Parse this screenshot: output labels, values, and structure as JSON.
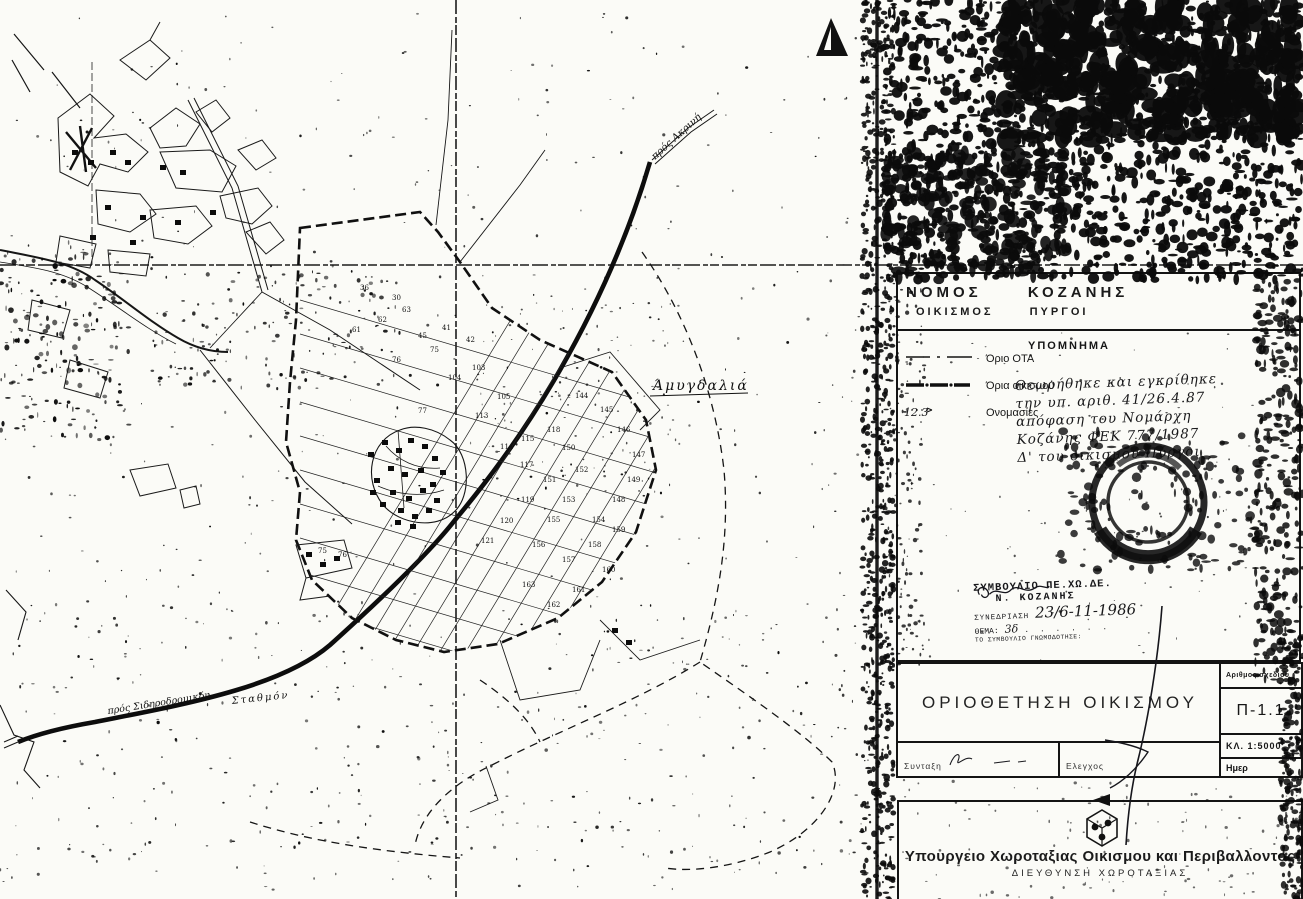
{
  "map": {
    "labels": {
      "area_name": "Άμυγδαλιά",
      "road_to_top": "πρός Ακρινή",
      "road_bottom_left": "πρός Σιδηροδρομικόν",
      "station": "Σταθμόν"
    },
    "parcel_numbers": [
      {
        "x": 418,
        "y": 413,
        "n": "77"
      },
      {
        "x": 448,
        "y": 380,
        "n": "104"
      },
      {
        "x": 472,
        "y": 370,
        "n": "103"
      },
      {
        "x": 497,
        "y": 399,
        "n": "105"
      },
      {
        "x": 475,
        "y": 418,
        "n": "113"
      },
      {
        "x": 500,
        "y": 449,
        "n": "114"
      },
      {
        "x": 521,
        "y": 441,
        "n": "115"
      },
      {
        "x": 520,
        "y": 467,
        "n": "117"
      },
      {
        "x": 547,
        "y": 432,
        "n": "118"
      },
      {
        "x": 562,
        "y": 450,
        "n": "150"
      },
      {
        "x": 543,
        "y": 482,
        "n": "151"
      },
      {
        "x": 575,
        "y": 472,
        "n": "152"
      },
      {
        "x": 562,
        "y": 502,
        "n": "153"
      },
      {
        "x": 592,
        "y": 522,
        "n": "154"
      },
      {
        "x": 547,
        "y": 522,
        "n": "155"
      },
      {
        "x": 521,
        "y": 502,
        "n": "119"
      },
      {
        "x": 500,
        "y": 523,
        "n": "120"
      },
      {
        "x": 481,
        "y": 543,
        "n": "121"
      },
      {
        "x": 532,
        "y": 547,
        "n": "156"
      },
      {
        "x": 562,
        "y": 562,
        "n": "157"
      },
      {
        "x": 588,
        "y": 547,
        "n": "158"
      },
      {
        "x": 612,
        "y": 532,
        "n": "159"
      },
      {
        "x": 602,
        "y": 572,
        "n": "160"
      },
      {
        "x": 572,
        "y": 592,
        "n": "161"
      },
      {
        "x": 547,
        "y": 607,
        "n": "162"
      },
      {
        "x": 522,
        "y": 587,
        "n": "163"
      },
      {
        "x": 612,
        "y": 502,
        "n": "148"
      },
      {
        "x": 627,
        "y": 482,
        "n": "149"
      },
      {
        "x": 632,
        "y": 457,
        "n": "147"
      },
      {
        "x": 617,
        "y": 432,
        "n": "146"
      },
      {
        "x": 600,
        "y": 412,
        "n": "145"
      },
      {
        "x": 575,
        "y": 398,
        "n": "144"
      },
      {
        "x": 352,
        "y": 332,
        "n": "61"
      },
      {
        "x": 378,
        "y": 322,
        "n": "62"
      },
      {
        "x": 402,
        "y": 312,
        "n": "63"
      },
      {
        "x": 430,
        "y": 352,
        "n": "75"
      },
      {
        "x": 392,
        "y": 362,
        "n": "76"
      },
      {
        "x": 318,
        "y": 553,
        "n": "75"
      },
      {
        "x": 338,
        "y": 557,
        "n": "76"
      },
      {
        "x": 442,
        "y": 330,
        "n": "41"
      },
      {
        "x": 466,
        "y": 342,
        "n": "42"
      },
      {
        "x": 418,
        "y": 338,
        "n": "45"
      },
      {
        "x": 392,
        "y": 300,
        "n": "30"
      },
      {
        "x": 360,
        "y": 290,
        "n": "36"
      }
    ]
  },
  "panel": {
    "header": {
      "line1": "ΝΟΜΟΣ ΚΟΖΑΝΗΣ",
      "line2": "ΟΙΚΙΣΜΟΣ ΠΥΡΓΟΙ"
    },
    "legend": {
      "title": "ΥΠΟΜΝΗΜΑ",
      "items": [
        {
          "symbol": "dash-dot-line",
          "label": "Όριο ΟΤΑ"
        },
        {
          "symbol": "thick-dash-line",
          "label": "Όρια οικισμού"
        },
        {
          "symbol": "parcel-number",
          "symbol_text": "12.3",
          "label": "Ονομασίες"
        }
      ]
    },
    "handwritten_note": {
      "lines": [
        "Θεωρήθηκε και εγκρίθηκε",
        "την υπ. αριθ. 41/26.4.87",
        "απόφαση του Νομάρχη",
        "Κοζάνης ΦΕΚ 777/1987",
        "Δ' του οικισμού Πύργοι"
      ]
    },
    "stamp": {
      "line1": "ΣΥΜΒΟΥΛΙΟ ΠΕ.ΧΩ.ΔΕ.",
      "line2": "Ν. ΚΟΖΑΝΗΣ",
      "session_label": "ΣΥΝΕΔΡΙΑΣΗ",
      "session_value": "23/6-11-1986",
      "topic_label": "ΘΕΜΑ:",
      "topic_value": "3δ",
      "footer": "ΤΟ ΣΥΜΒΟΥΛΙΟ ΓΝΩΜΟΔΟΤΗΣΕ:"
    },
    "titleblock": {
      "title": "ΟΡΙΟΘΕΤΗΣΗ ΟΙΚΙΣΜΟΥ",
      "drawing_no_label": "Αριθμος σχεδιου",
      "drawing_no": "Π-1.1",
      "scale": "ΚΛ. 1:5000",
      "date_label": "Ημερ",
      "drafting_label": "Συνταξη",
      "check_label": "Ελεγχος"
    },
    "ministry": {
      "name": "Υπουργειο Χωροταξιας Οικισμου και Περιβαλλοντος",
      "department": "ΔΙΕΥΘΥΝΣΗ ΧΩΡΟΤΑΞΙΑΣ"
    }
  },
  "colors": {
    "ink": "#141414",
    "paper": "#fbfbf7"
  }
}
